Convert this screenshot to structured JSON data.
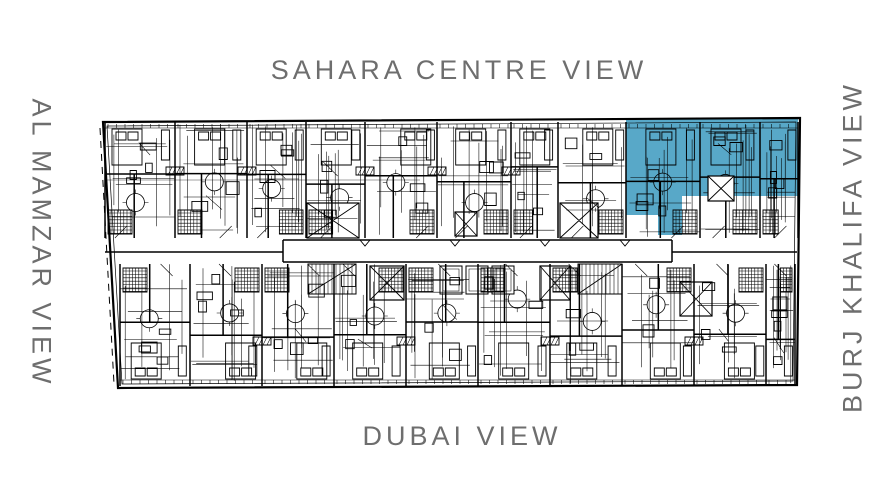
{
  "page": {
    "background_color": "#ffffff"
  },
  "labels": {
    "color": "#6e6e6e",
    "top": {
      "text": "SAHARA CENTRE VIEW"
    },
    "left": {
      "text": "AL MAMZAR VIEW"
    },
    "right": {
      "text": "BURJ KHALIFA VIEW"
    },
    "bottom": {
      "text": "DUBAI VIEW"
    }
  },
  "floorplan": {
    "line_color": "#000000",
    "background": "#ffffff",
    "highlight": {
      "color": "#58a8c8",
      "polygon": [
        [
          626,
          120
        ],
        [
          798,
          118
        ],
        [
          798,
          196
        ],
        [
          682,
          196
        ],
        [
          682,
          235
        ],
        [
          658,
          235
        ],
        [
          658,
          215
        ],
        [
          626,
          215
        ]
      ],
      "stair_cutout": [
        708,
        176,
        26,
        25
      ]
    }
  }
}
